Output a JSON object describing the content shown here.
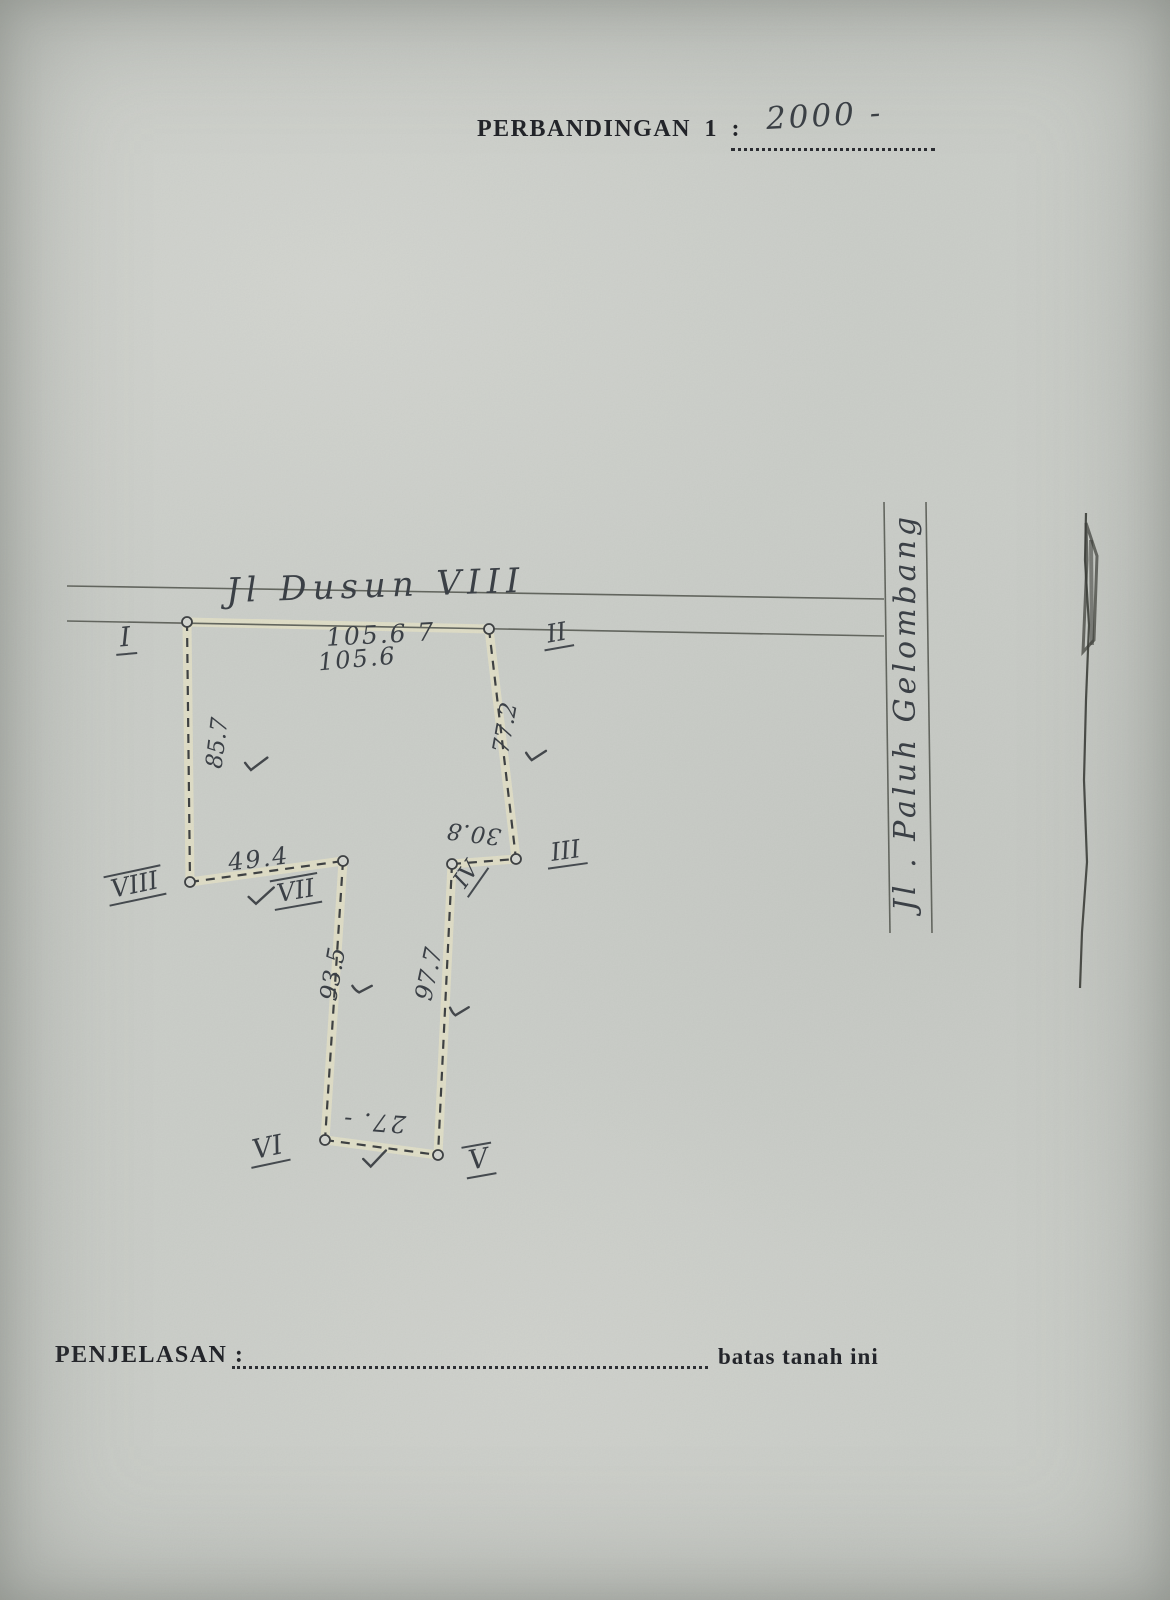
{
  "header": {
    "label": "PERBANDINGAN   1   :",
    "scale_value": "2000 -"
  },
  "sketch": {
    "top_road_label": "Jl   Dusun  VIII",
    "right_road_label": "Jl . Paluh  Gelombang",
    "measurements": {
      "top_a": "105.6  7",
      "top_b": "105.6",
      "west": "85.7",
      "east": "77.2",
      "shelf": "49.4",
      "notch": "30.8",
      "lower_west": "93.5",
      "lower_east": "97.7",
      "south": "27. -"
    },
    "points": {
      "p1": "I",
      "p2": "II",
      "p3": "III",
      "p4": "IV",
      "p5": "V",
      "p6": "VI",
      "p7": "VII",
      "p8": "VIII"
    }
  },
  "footer": {
    "label": "PENJELASAN  :",
    "suffix": "batas  tanah  ini"
  }
}
